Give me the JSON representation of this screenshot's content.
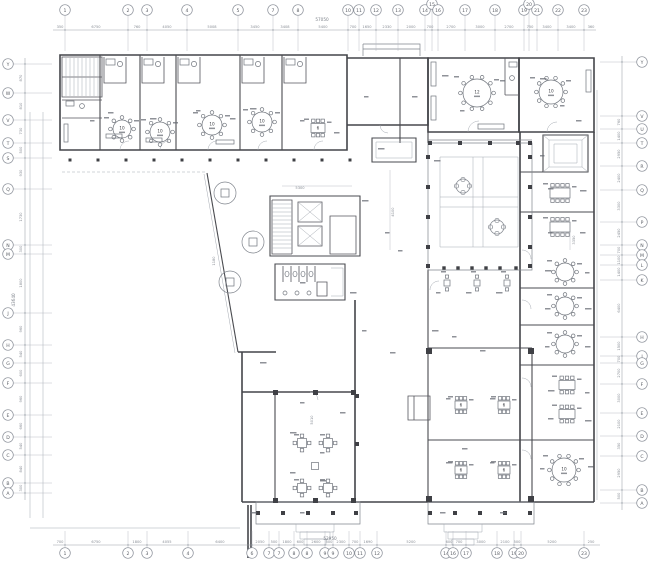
{
  "drawing": {
    "type": "architectural-floor-plan",
    "colors": {
      "wall": "#44454a",
      "dimension": "#9aa0a8",
      "dim_text": "#888d95",
      "paper": "#ffffff"
    }
  },
  "grid": {
    "top": {
      "total": "57050",
      "total_x": 322,
      "total_y": 20,
      "bubbles": [
        {
          "label": "1",
          "x": 65
        },
        {
          "label": "2",
          "x": 128
        },
        {
          "label": "3",
          "x": 147
        },
        {
          "label": "4",
          "x": 187
        },
        {
          "label": "5",
          "x": 238
        },
        {
          "label": "7",
          "x": 273
        },
        {
          "label": "8",
          "x": 298
        },
        {
          "label": "10",
          "x": 348
        },
        {
          "label": "11",
          "x": 359
        },
        {
          "label": "12",
          "x": 376
        },
        {
          "label": "13",
          "x": 398
        },
        {
          "label": "14",
          "x": 425
        },
        {
          "label": "15",
          "x": 432,
          "raised": true
        },
        {
          "label": "16",
          "x": 438
        },
        {
          "label": "17",
          "x": 465
        },
        {
          "label": "18",
          "x": 495
        },
        {
          "label": "19",
          "x": 524
        },
        {
          "label": "20",
          "x": 529,
          "raised": true
        },
        {
          "label": "21",
          "x": 537
        },
        {
          "label": "22",
          "x": 558
        },
        {
          "label": "23",
          "x": 584
        }
      ],
      "dims": [
        {
          "text": "350",
          "x": 60
        },
        {
          "text": "6750",
          "x": 96
        },
        {
          "text": "760",
          "x": 137
        },
        {
          "text": "4050",
          "x": 167
        },
        {
          "text": "5008",
          "x": 212
        },
        {
          "text": "3450",
          "x": 255
        },
        {
          "text": "3408",
          "x": 285
        },
        {
          "text": "5400",
          "x": 323
        },
        {
          "text": "700",
          "x": 353
        },
        {
          "text": "1650",
          "x": 367
        },
        {
          "text": "2330",
          "x": 387
        },
        {
          "text": "2000",
          "x": 411
        },
        {
          "text": "700",
          "x": 430
        },
        {
          "text": "2700",
          "x": 451
        },
        {
          "text": "3000",
          "x": 480
        },
        {
          "text": "2700",
          "x": 509
        },
        {
          "text": "750",
          "x": 530
        },
        {
          "text": "3400",
          "x": 547
        },
        {
          "text": "3400",
          "x": 571
        },
        {
          "text": "360",
          "x": 591
        }
      ]
    },
    "bottom": {
      "total": "52950",
      "total_x": 330,
      "total_y": 539,
      "bubbles": [
        {
          "label": "1",
          "x": 65
        },
        {
          "label": "2",
          "x": 128
        },
        {
          "label": "3",
          "x": 147
        },
        {
          "label": "4",
          "x": 188
        },
        {
          "label": "6",
          "x": 252
        },
        {
          "label": "7",
          "x": 269
        },
        {
          "label": "7",
          "x": 279
        },
        {
          "label": "8",
          "x": 294
        },
        {
          "label": "8",
          "x": 307
        },
        {
          "label": "9",
          "x": 325
        },
        {
          "label": "9",
          "x": 333
        },
        {
          "label": "10",
          "x": 349
        },
        {
          "label": "11",
          "x": 360
        },
        {
          "label": "12",
          "x": 377
        },
        {
          "label": "14",
          "x": 446
        },
        {
          "label": "16",
          "x": 453
        },
        {
          "label": "17",
          "x": 466
        },
        {
          "label": "18",
          "x": 497
        },
        {
          "label": "19",
          "x": 514
        },
        {
          "label": "20",
          "x": 521
        },
        {
          "label": "23",
          "x": 584
        }
      ],
      "dims": [
        {
          "text": "700",
          "x": 60
        },
        {
          "text": "6750",
          "x": 96
        },
        {
          "text": "1800",
          "x": 137
        },
        {
          "text": "4055",
          "x": 167
        },
        {
          "text": "6400",
          "x": 220
        },
        {
          "text": "2050",
          "x": 260
        },
        {
          "text": "500",
          "x": 274
        },
        {
          "text": "1800",
          "x": 287
        },
        {
          "text": "600",
          "x": 300
        },
        {
          "text": "2600",
          "x": 316
        },
        {
          "text": "500",
          "x": 329
        },
        {
          "text": "2300",
          "x": 341
        },
        {
          "text": "700",
          "x": 355
        },
        {
          "text": "1690",
          "x": 368
        },
        {
          "text": "5200",
          "x": 411
        },
        {
          "text": "600",
          "x": 449
        },
        {
          "text": "700",
          "x": 459
        },
        {
          "text": "3000",
          "x": 481
        },
        {
          "text": "2100",
          "x": 505
        },
        {
          "text": "500",
          "x": 517
        },
        {
          "text": "5200",
          "x": 552
        },
        {
          "text": "250",
          "x": 591
        }
      ]
    },
    "left": {
      "total": "43640",
      "total_x": 14,
      "total_y": 300,
      "bubbles": [
        {
          "label": "Y",
          "y": 64
        },
        {
          "label": "W",
          "y": 93
        },
        {
          "label": "V",
          "y": 120
        },
        {
          "label": "T",
          "y": 143
        },
        {
          "label": "S",
          "y": 158
        },
        {
          "label": "Q",
          "y": 189
        },
        {
          "label": "N",
          "y": 245
        },
        {
          "label": "M",
          "y": 254
        },
        {
          "label": "J",
          "y": 313
        },
        {
          "label": "H",
          "y": 345
        },
        {
          "label": "G",
          "y": 363
        },
        {
          "label": "F",
          "y": 383
        },
        {
          "label": "E",
          "y": 415
        },
        {
          "label": "D",
          "y": 437
        },
        {
          "label": "C",
          "y": 455
        },
        {
          "label": "B",
          "y": 483
        },
        {
          "label": "A",
          "y": 493
        }
      ],
      "dims": [
        {
          "text": "870",
          "y": 78
        },
        {
          "text": "810",
          "y": 106
        },
        {
          "text": "730",
          "y": 131
        },
        {
          "text": "500",
          "y": 150
        },
        {
          "text": "930",
          "y": 173
        },
        {
          "text": "1730",
          "y": 217
        },
        {
          "text": "300",
          "y": 249
        },
        {
          "text": "1800",
          "y": 283
        },
        {
          "text": "960",
          "y": 329
        },
        {
          "text": "540",
          "y": 354
        },
        {
          "text": "600",
          "y": 373
        },
        {
          "text": "960",
          "y": 399
        },
        {
          "text": "660",
          "y": 426
        },
        {
          "text": "540",
          "y": 446
        },
        {
          "text": "840",
          "y": 469
        },
        {
          "text": "300",
          "y": 488
        }
      ]
    },
    "right": {
      "bubbles": [
        {
          "label": "Y",
          "y": 62
        },
        {
          "label": "V",
          "y": 116
        },
        {
          "label": "U",
          "y": 129
        },
        {
          "label": "T",
          "y": 143
        },
        {
          "label": "R",
          "y": 166
        },
        {
          "label": "Q",
          "y": 190
        },
        {
          "label": "P",
          "y": 222
        },
        {
          "label": "N",
          "y": 245
        },
        {
          "label": "M",
          "y": 255
        },
        {
          "label": "L",
          "y": 265
        },
        {
          "label": "K",
          "y": 280
        },
        {
          "label": "H",
          "y": 337
        },
        {
          "label": "J",
          "y": 356
        },
        {
          "label": "G",
          "y": 363
        },
        {
          "label": "F",
          "y": 384
        },
        {
          "label": "E",
          "y": 413
        },
        {
          "label": "D",
          "y": 436
        },
        {
          "label": "C",
          "y": 456
        },
        {
          "label": "B",
          "y": 490
        },
        {
          "label": "A",
          "y": 503
        }
      ],
      "dims": [
        {
          "text": "760",
          "y": 122
        },
        {
          "text": "1400",
          "y": 136
        },
        {
          "text": "2950",
          "y": 154
        },
        {
          "text": "2400",
          "y": 178
        },
        {
          "text": "3300",
          "y": 206
        },
        {
          "text": "2450",
          "y": 233
        },
        {
          "text": "700",
          "y": 250
        },
        {
          "text": "1100",
          "y": 260
        },
        {
          "text": "1400",
          "y": 272
        },
        {
          "text": "6400",
          "y": 308
        },
        {
          "text": "1500",
          "y": 346
        },
        {
          "text": "700",
          "y": 359
        },
        {
          "text": "2700",
          "y": 373
        },
        {
          "text": "3000",
          "y": 398
        },
        {
          "text": "2100",
          "y": 424
        },
        {
          "text": "350",
          "y": 446
        },
        {
          "text": "2950",
          "y": 473
        },
        {
          "text": "500",
          "y": 496
        }
      ]
    }
  },
  "interior_dims": [
    {
      "text": "5300",
      "x": 300,
      "y": 188,
      "rot": 0
    },
    {
      "text": "1180",
      "x": 214,
      "y": 261,
      "rot": 1
    },
    {
      "text": "4100",
      "x": 393,
      "y": 212,
      "rot": 1
    },
    {
      "text": "3350",
      "x": 574,
      "y": 240,
      "rot": 1
    },
    {
      "text": "5010",
      "x": 312,
      "y": 420,
      "rot": 1
    }
  ],
  "tables": {
    "round": [
      {
        "label": "10",
        "x": 122,
        "y": 129,
        "r": 9
      },
      {
        "label": "10",
        "x": 160,
        "y": 132,
        "r": 10
      },
      {
        "label": "10",
        "x": 212,
        "y": 125,
        "r": 10
      },
      {
        "label": "10",
        "x": 262,
        "y": 122,
        "r": 10
      },
      {
        "label": "12",
        "x": 477,
        "y": 93,
        "r": 14
      },
      {
        "label": "10",
        "x": 551,
        "y": 92,
        "r": 12
      },
      {
        "label": "",
        "x": 565,
        "y": 272,
        "r": 9
      },
      {
        "label": "",
        "x": 565,
        "y": 306,
        "r": 9
      },
      {
        "label": "",
        "x": 565,
        "y": 344,
        "r": 9
      },
      {
        "label": "10",
        "x": 564,
        "y": 470,
        "r": 12
      }
    ],
    "rect": [
      {
        "label": "6",
        "x": 318,
        "y": 128,
        "w": 14,
        "h": 9
      },
      {
        "label": "",
        "x": 560,
        "y": 193,
        "w": 20,
        "h": 10
      },
      {
        "label": "",
        "x": 560,
        "y": 227,
        "w": 20,
        "h": 10
      },
      {
        "label": "",
        "x": 567,
        "y": 385,
        "w": 16,
        "h": 9
      },
      {
        "label": "",
        "x": 567,
        "y": 414,
        "w": 16,
        "h": 9
      },
      {
        "label": "6",
        "x": 461,
        "y": 405,
        "w": 12,
        "h": 8
      },
      {
        "label": "6",
        "x": 504,
        "y": 405,
        "w": 12,
        "h": 8
      },
      {
        "label": "6",
        "x": 461,
        "y": 470,
        "w": 12,
        "h": 8
      },
      {
        "label": "6",
        "x": 504,
        "y": 470,
        "w": 12,
        "h": 8
      }
    ],
    "square4": [
      {
        "x": 302,
        "y": 443
      },
      {
        "x": 328,
        "y": 443
      },
      {
        "x": 302,
        "y": 488
      },
      {
        "x": 328,
        "y": 488
      },
      {
        "x": 315,
        "y": 466,
        "small": true
      }
    ],
    "duo": [
      {
        "x": 447,
        "y": 283
      },
      {
        "x": 477,
        "y": 283
      },
      {
        "x": 507,
        "y": 283
      }
    ]
  }
}
